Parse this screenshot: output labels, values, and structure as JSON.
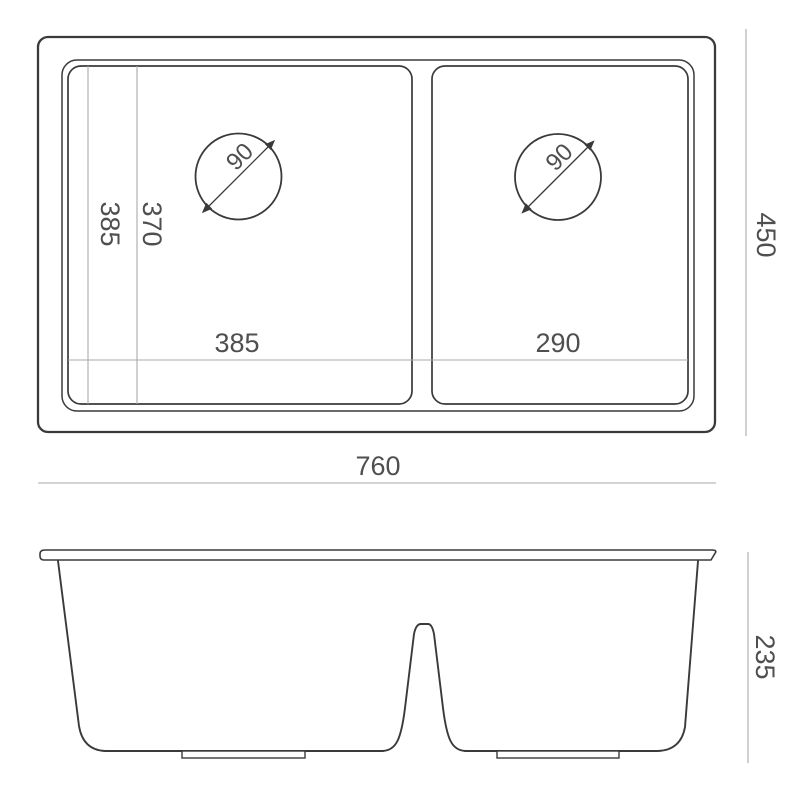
{
  "colors": {
    "line": "#3a3a3a",
    "dim_line": "#a9a9a9",
    "label": "#4f4f4f",
    "background": "#ffffff"
  },
  "top_view": {
    "overall_width": "760",
    "overall_depth": "450",
    "left_bowl_width": "385",
    "right_bowl_width": "290",
    "left_bowl_length": "385",
    "left_bowl_inner_length": "370",
    "left_drain_diameter": "90",
    "right_drain_diameter": "90"
  },
  "side_view": {
    "bowl_depth": "235"
  }
}
